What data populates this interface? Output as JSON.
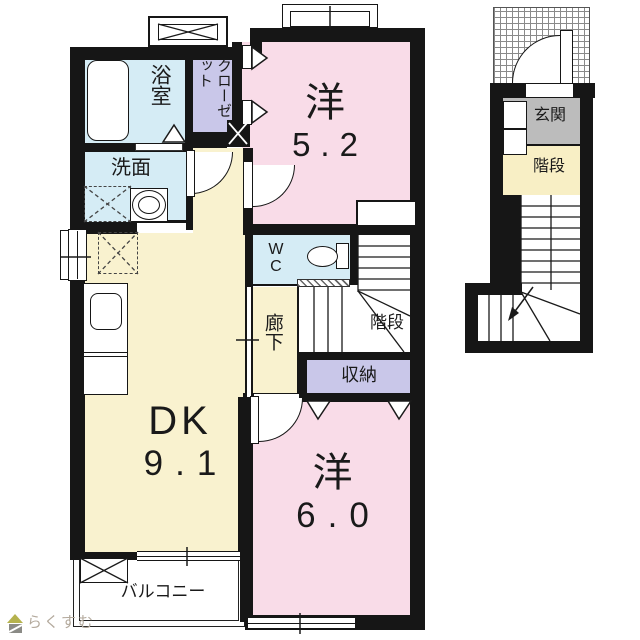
{
  "plan_2f": {
    "name": "2F main plan",
    "rooms": {
      "bathroom": {
        "label": "浴室"
      },
      "closet": {
        "label": "クローゼット"
      },
      "washroom": {
        "label": "洗面"
      },
      "western_5_2": {
        "label": "洋",
        "area": "5.2"
      },
      "wc": {
        "label": "WC"
      },
      "hallway": {
        "label": "廊下"
      },
      "stairs": {
        "label": "階段"
      },
      "storage": {
        "label": "収納"
      },
      "dining_kitchen": {
        "label": "DK",
        "area": "9.1"
      },
      "western_6_0": {
        "label": "洋",
        "area": "6.0"
      },
      "balcony": {
        "label": "バルコニー"
      }
    }
  },
  "plan_1f": {
    "name": "1F entrance plan",
    "rooms": {
      "entrance": {
        "label": "玄関"
      },
      "stairs": {
        "label": "階段"
      }
    }
  },
  "watermark": {
    "text": "らくすむ"
  },
  "colors": {
    "wall": "#161616",
    "water_rooms_blue": "#d5ecf5",
    "closet_purple": "#c9c7e9",
    "western_room_pink": "#f9dce8",
    "dk_yellow": "#f9f2cf",
    "stairs_yellow": "#f8efc5",
    "entrance_gray": "#bcbcbc",
    "logo_text": "#b3a99c",
    "logo_roof": "#b5b24e",
    "logo_body": "#8b8b86"
  }
}
